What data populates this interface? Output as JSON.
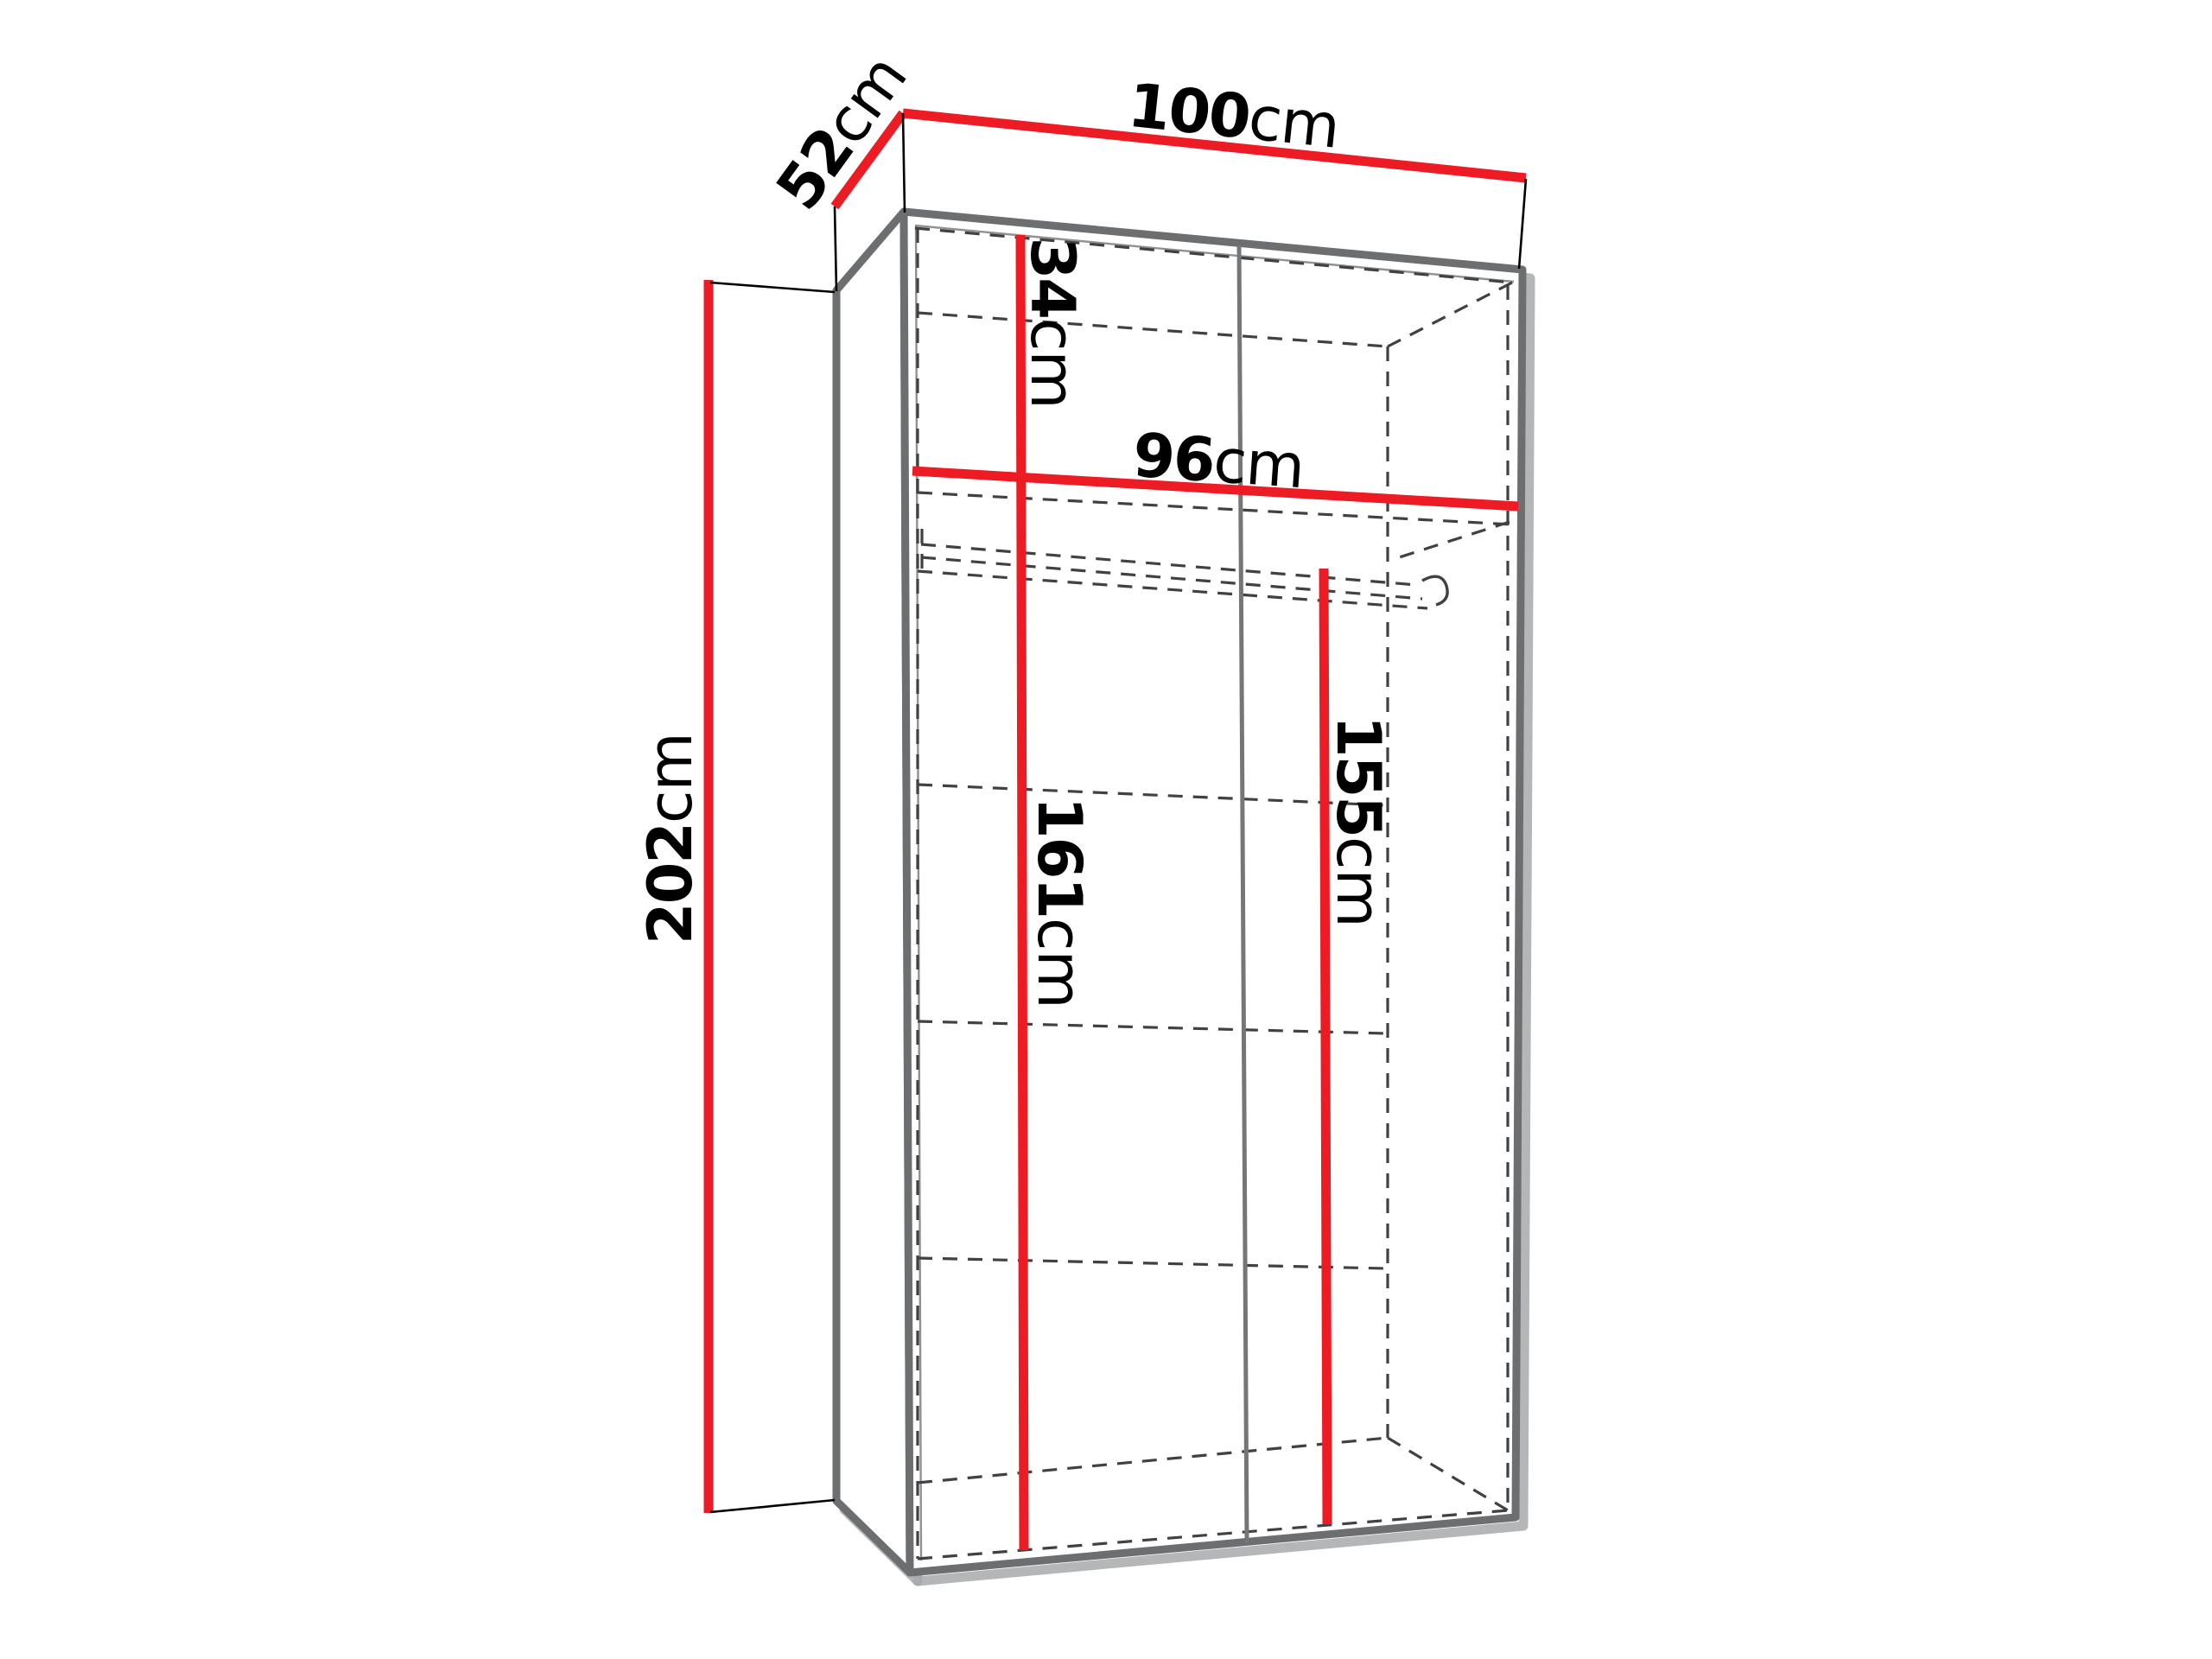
{
  "diagram": {
    "type": "furniture-dimension-diagram",
    "subject": "two-door wardrobe shown in perspective with top shelf, side shelves and hanging rail (hidden edges dashed)",
    "unit": "cm",
    "dimensions": {
      "overall_width": {
        "number": "100",
        "unit": "cm"
      },
      "overall_depth": {
        "number": "52",
        "unit": "cm"
      },
      "overall_height": {
        "number": "202",
        "unit": "cm"
      },
      "top_section_height": {
        "number": "34",
        "unit": "cm"
      },
      "interior_width": {
        "number": "96",
        "unit": "cm"
      },
      "left_interior_height": {
        "number": "161",
        "unit": "cm"
      },
      "hanging_section_height": {
        "number": "155",
        "unit": "cm"
      }
    },
    "colors": {
      "dimension_line": "#ed1c24",
      "cabinet_edge": "#6d6e70",
      "edge_shadow": "#a7a9ac",
      "hidden_edge": "#414042",
      "label_text": "#000000",
      "background": "#ffffff"
    }
  }
}
